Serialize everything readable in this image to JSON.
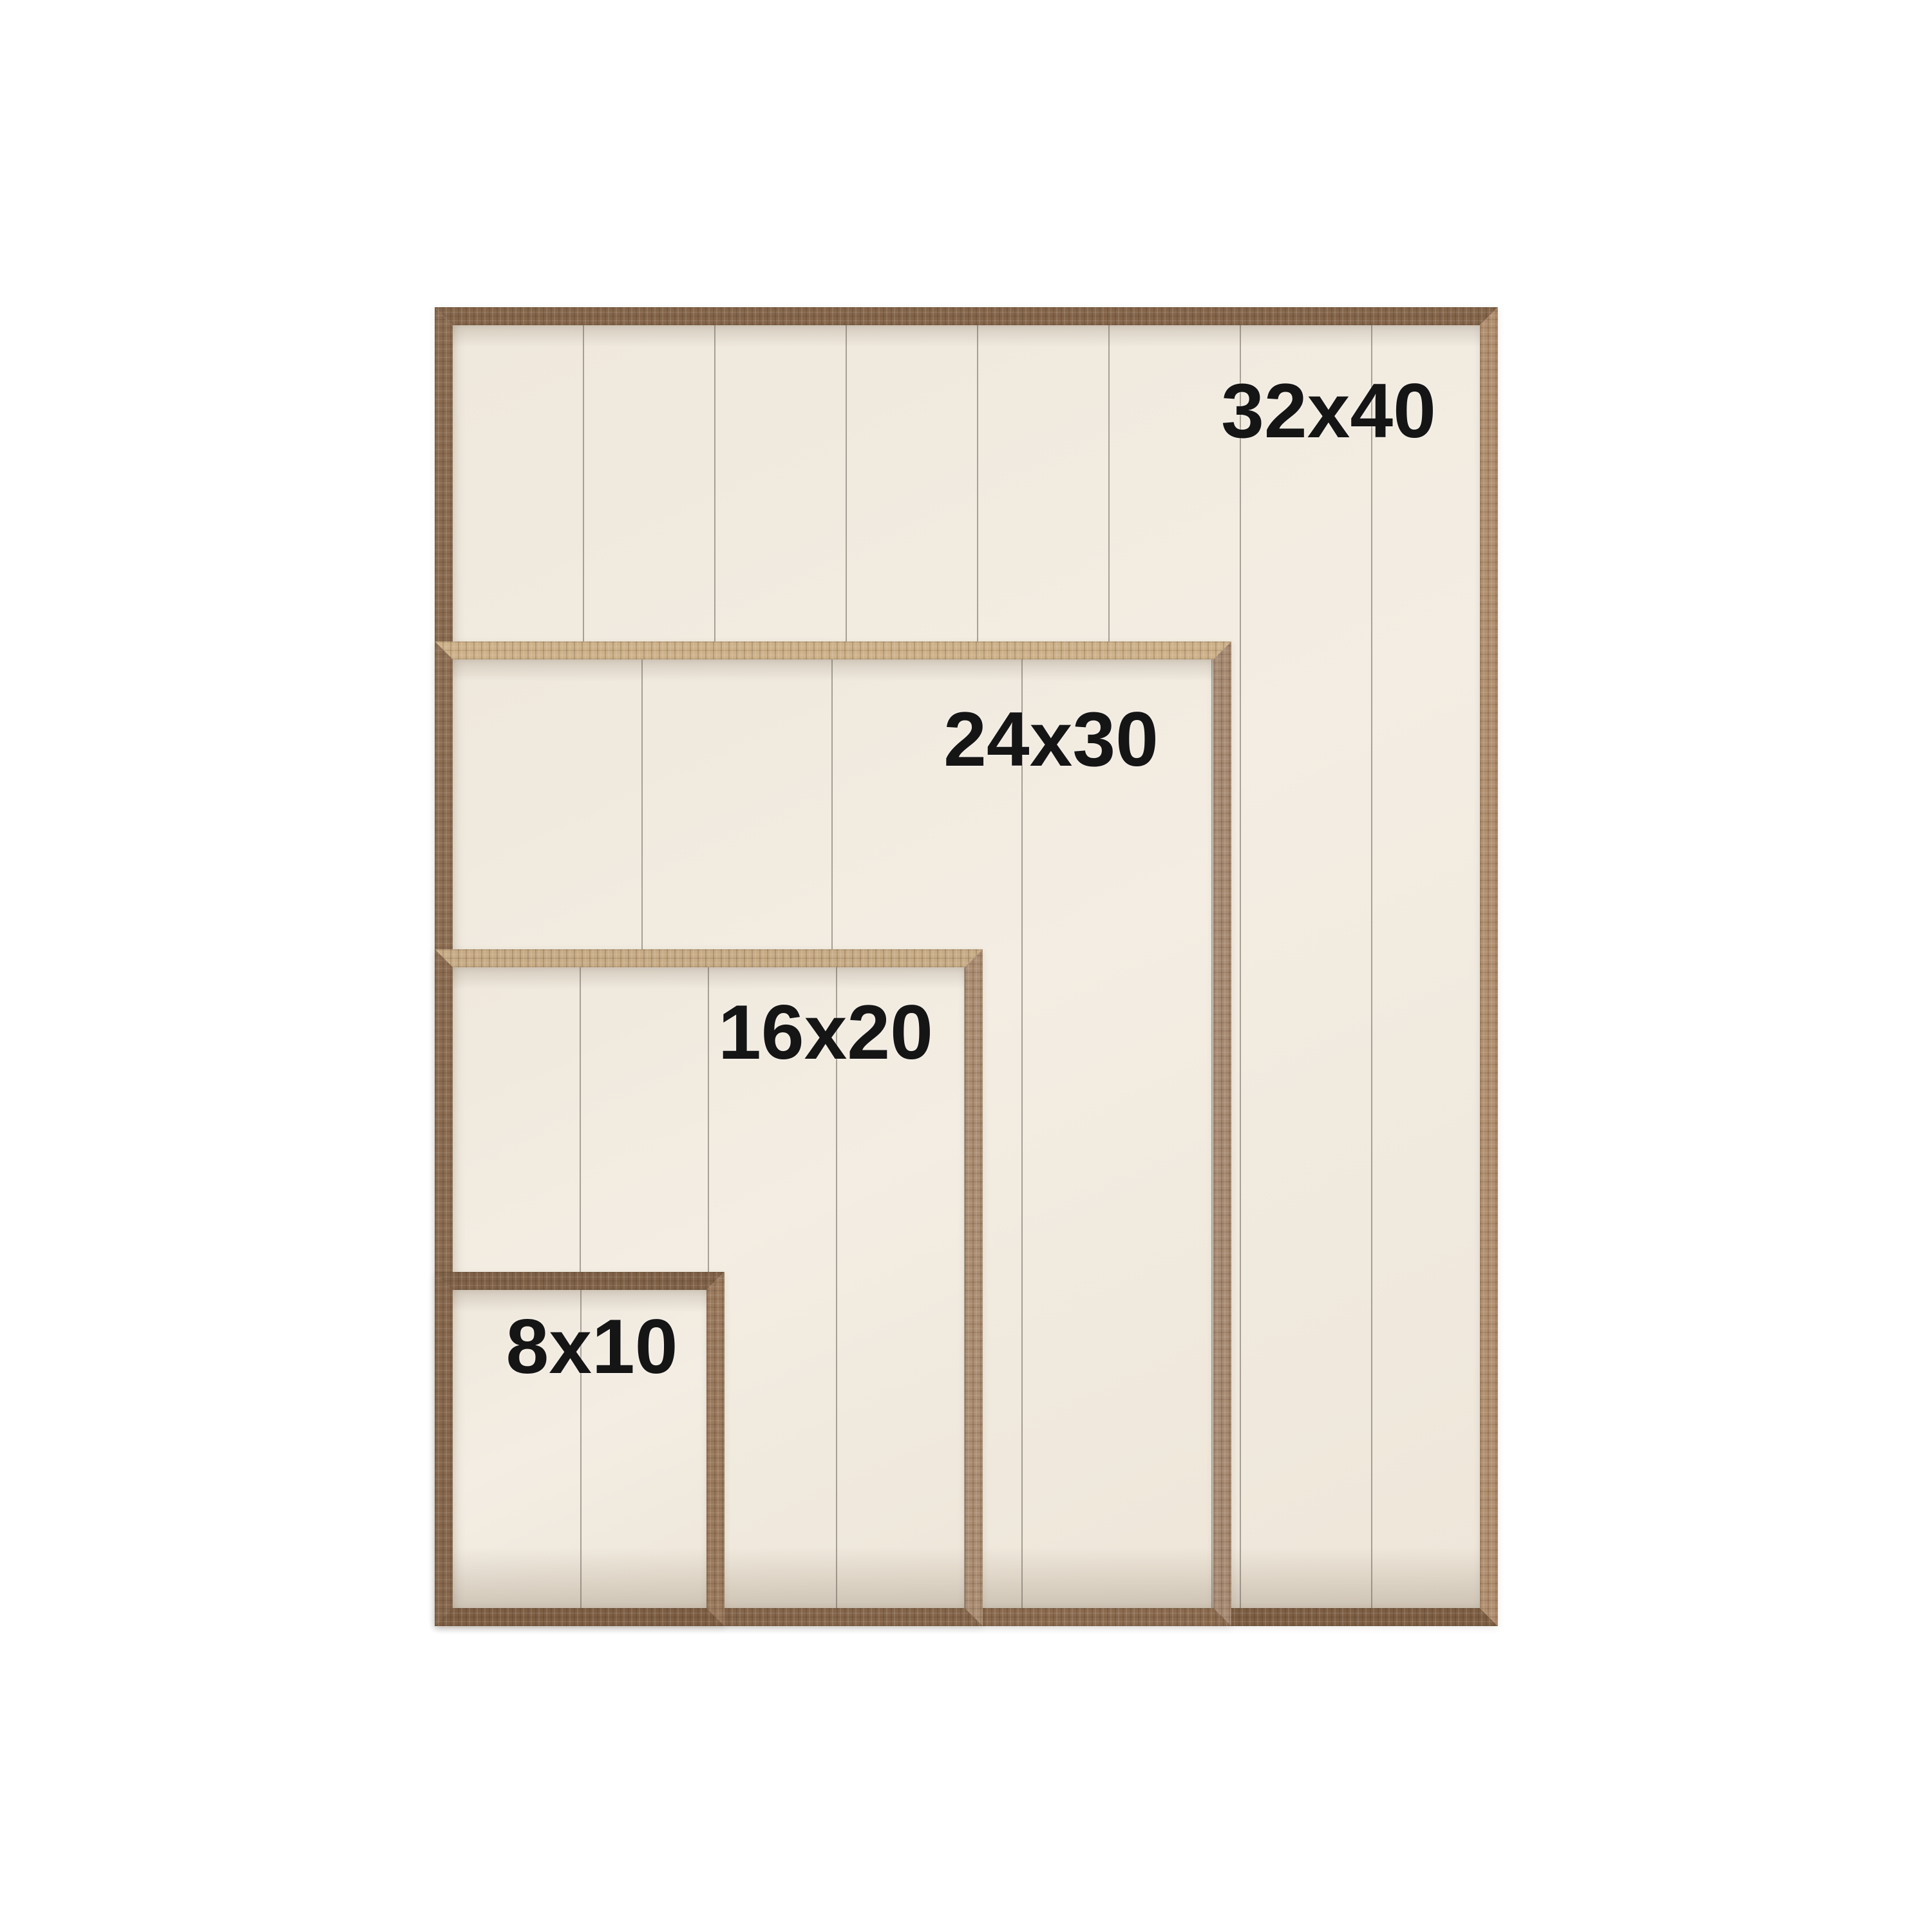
{
  "page": {
    "background": "#ffffff",
    "description_labels_only": true
  },
  "frames": [
    {
      "id": "frame-32x40",
      "label": "32x40"
    },
    {
      "id": "frame-24x30",
      "label": "24x30"
    },
    {
      "id": "frame-16x20",
      "label": "16x20"
    },
    {
      "id": "frame-8x10",
      "label": "8x10"
    }
  ],
  "colors": {
    "background": "#ffffff",
    "panel_cream": "#f1eadf",
    "plank_seam": "#8f897f",
    "wood_walnut_dark": "#7d5e43",
    "wood_walnut_mid": "#8a6b50",
    "wood_tan_light": "#cdb189",
    "wood_pink_tan": "#ab8d72",
    "label_text": "#151515"
  }
}
